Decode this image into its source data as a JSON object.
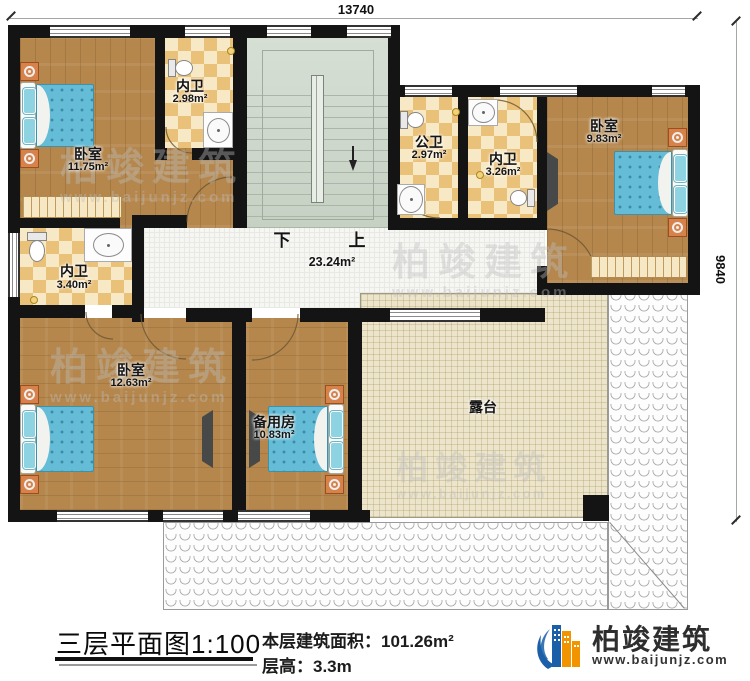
{
  "dimensions": {
    "top": "13740",
    "right": "9840"
  },
  "rooms": {
    "bedroom_tl": {
      "name": "卧室",
      "area": "11.75m²"
    },
    "bath_tl": {
      "name": "内卫",
      "area": "2.98m²"
    },
    "bath_public": {
      "name": "公卫",
      "area": "2.97m²"
    },
    "bath_tr": {
      "name": "内卫",
      "area": "3.26m²"
    },
    "bedroom_tr": {
      "name": "卧室",
      "area": "9.83m²"
    },
    "bath_ml": {
      "name": "内卫",
      "area": "3.40m²"
    },
    "bedroom_bl": {
      "name": "卧室",
      "area": "12.63m²"
    },
    "spare": {
      "name": "备用房",
      "area": "10.83m²"
    },
    "terrace": {
      "name": "露台"
    },
    "hall": {
      "area": "23.24m²"
    }
  },
  "stairs": {
    "down": "下",
    "up": "上"
  },
  "watermark": {
    "brand": "柏竣建筑",
    "site": "www.baijunjz.com"
  },
  "footer": {
    "title": "三层平面图",
    "scale": "1:100",
    "area_label": "本层建筑面积：",
    "area_value": "101.26m²",
    "height_label": "层高：",
    "height_value": "3.3m"
  },
  "logo": {
    "brand": "柏竣建筑",
    "site": "www.baijunjz.com"
  },
  "colors": {
    "wall": "#141414",
    "wood": "#b5874d",
    "tile": "#eac179",
    "stairs": "#ccd6ca",
    "terrace": "#ece4cb",
    "hall": "#f6f6f3",
    "bed": "#64bcd6",
    "brand_blue": "#1a5fa8",
    "brand_orange": "#f29400"
  }
}
